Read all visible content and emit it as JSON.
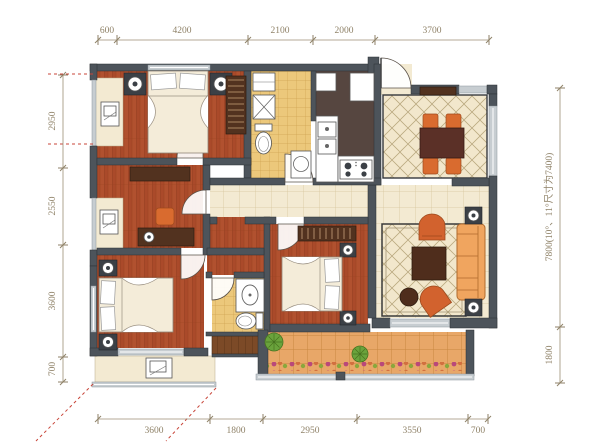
{
  "plan": {
    "type": "apartment-floor-plan",
    "dimensions": {
      "top": [
        "600",
        "4200",
        "2100",
        "2000",
        "3700"
      ],
      "bottom": [
        "3600",
        "1800",
        "2950",
        "3550",
        "700"
      ],
      "left": [
        "2950",
        "2550",
        "3600",
        "700"
      ],
      "right": [
        "7800(10°、11°尺寸为7400)",
        "1800"
      ]
    },
    "colors": {
      "wall": "#4d545b",
      "wood_floor": "#b1512f",
      "tile_cream": "#f3ead2",
      "tile_bathroom_yellow": "#ecc87b",
      "kitchen_floor": "#564640",
      "furniture_orange": "#d96b2f",
      "furniture_dark_wood": "#52321f",
      "sofa_orange": "#f0a55f",
      "balcony_tile": "#e8a768",
      "plant_green": "#6aa33c",
      "dimension_text": "#8f8268",
      "marker_red_dashed": "#c84438"
    },
    "icons": [
      "double-bed-icon",
      "single-bed-icon",
      "nightstand-icon",
      "wardrobe-icon",
      "desk-icon",
      "chair-icon",
      "toilet-icon",
      "shower-icon",
      "washing-machine-icon",
      "kitchen-sink-icon",
      "stove-icon",
      "refrigerator-icon",
      "dining-table-icon",
      "dining-chair-icon",
      "sofa-icon",
      "coffee-table-icon",
      "armchair-icon",
      "side-table-icon",
      "speaker-icon",
      "basin-icon",
      "plant-icon",
      "door-swing-icon",
      "balcony-chair-icon"
    ]
  }
}
